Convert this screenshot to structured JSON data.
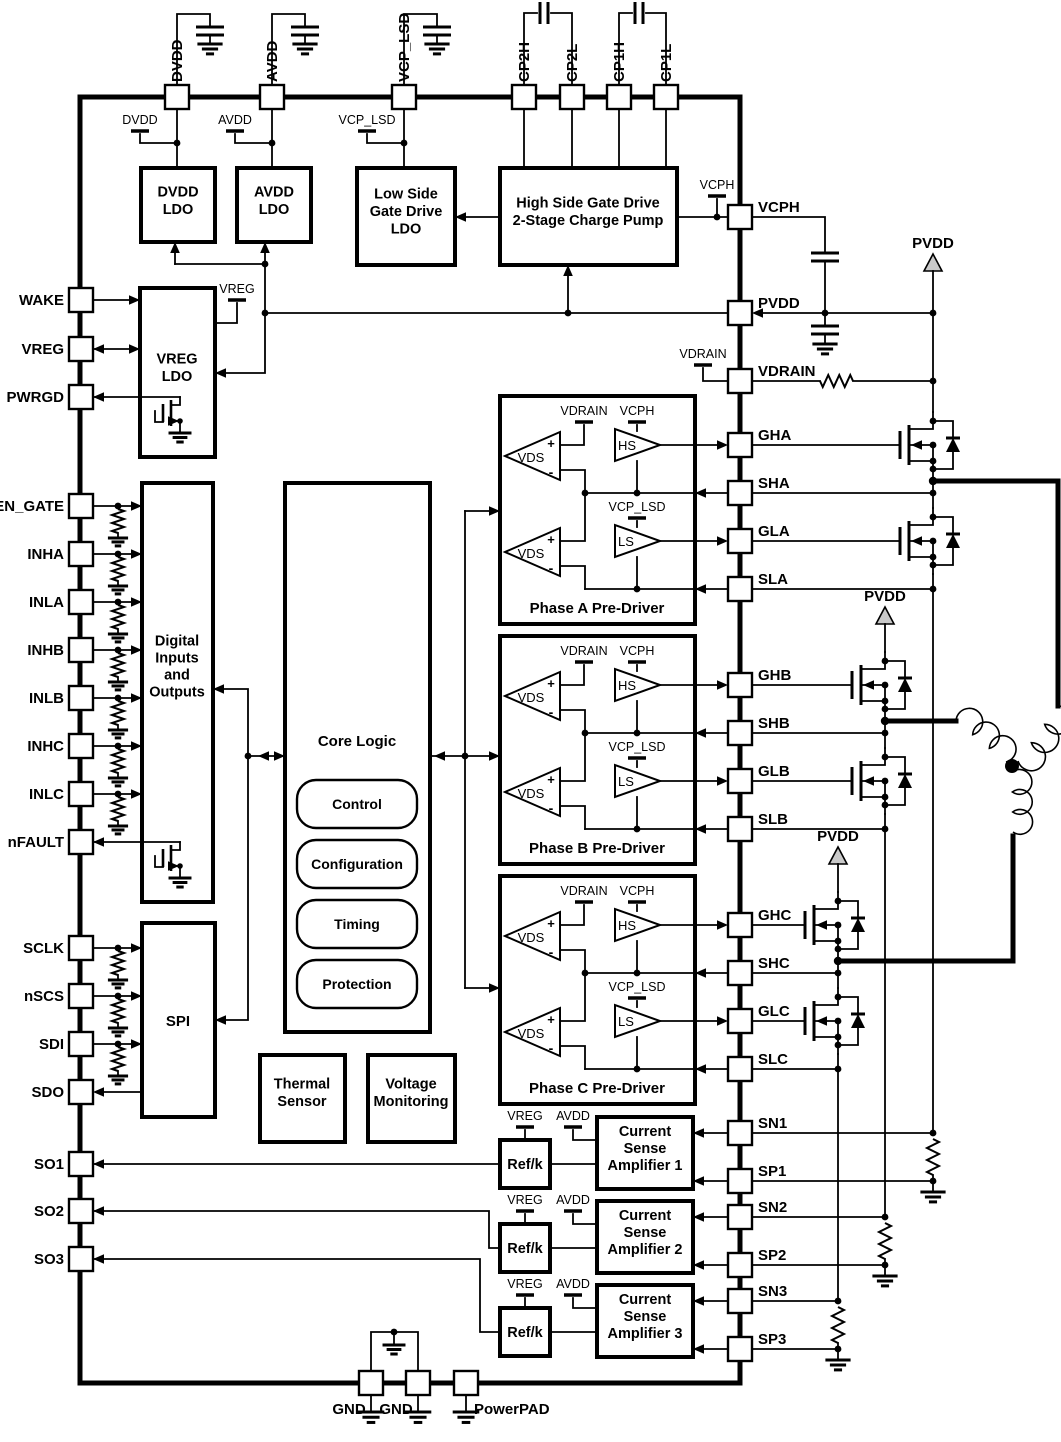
{
  "diagram_type": "ic-functional-block-diagram",
  "pins": {
    "top": [
      "DVDD",
      "AVDD",
      "VCP_LSD",
      "CP2H",
      "CP2L",
      "CP1H",
      "CP1L"
    ],
    "left": [
      "WAKE",
      "VREG",
      "PWRGD",
      "EN_GATE",
      "INHA",
      "INLA",
      "INHB",
      "INLB",
      "INHC",
      "INLC",
      "nFAULT",
      "SCLK",
      "nSCS",
      "SDI",
      "SDO",
      "SO1",
      "SO2",
      "SO3"
    ],
    "right": [
      "VCPH",
      "PVDD",
      "VDRAIN",
      "GHA",
      "SHA",
      "GLA",
      "SLA",
      "GHB",
      "SHB",
      "GLB",
      "SLB",
      "GHC",
      "SHC",
      "GLC",
      "SLC",
      "SN1",
      "SP1",
      "SN2",
      "SP2",
      "SN3",
      "SP3"
    ],
    "bottom": [
      "GND",
      "GND",
      "PowerPAD"
    ]
  },
  "blocks": {
    "dvdd_ldo": {
      "lines": [
        "DVDD",
        "LDO"
      ]
    },
    "avdd_ldo": {
      "lines": [
        "AVDD",
        "LDO"
      ]
    },
    "lowside_ldo": {
      "lines": [
        "Low Side",
        "Gate Drive",
        "LDO"
      ]
    },
    "charge_pump": {
      "lines": [
        "High Side Gate Drive",
        "2-Stage Charge Pump"
      ]
    },
    "vreg_ldo": {
      "lines": [
        "VREG",
        "LDO"
      ]
    },
    "digital_io": {
      "lines": [
        "Digital",
        "Inputs",
        "and",
        "Outputs"
      ]
    },
    "core_logic": {
      "title": "Core Logic",
      "modules": [
        "Control",
        "Configuration",
        "Timing",
        "Protection"
      ]
    },
    "spi": {
      "lines": [
        "SPI"
      ]
    },
    "thermal_sensor": {
      "lines": [
        "Thermal",
        "Sensor"
      ]
    },
    "voltage_monitoring": {
      "lines": [
        "Voltage",
        "Monitoring"
      ]
    },
    "phase_a": {
      "label": "Phase A Pre-Driver"
    },
    "phase_b": {
      "label": "Phase B Pre-Driver"
    },
    "phase_c": {
      "label": "Phase C Pre-Driver"
    },
    "ref_k": {
      "label": "Ref/k"
    },
    "csa1": {
      "lines": [
        "Current",
        "Sense",
        "Amplifier 1"
      ]
    },
    "csa2": {
      "lines": [
        "Current",
        "Sense",
        "Amplifier 2"
      ]
    },
    "csa3": {
      "lines": [
        "Current",
        "Sense",
        "Amplifier 3"
      ]
    }
  },
  "predriver_symbols": {
    "hs": "HS",
    "ls": "LS",
    "vds": "VDS",
    "plus": "+",
    "minus": "-"
  },
  "supplies": {
    "dvdd": "DVDD",
    "avdd": "AVDD",
    "vcp_lsd": "VCP_LSD",
    "vcph": "VCPH",
    "vreg": "VREG",
    "vdrain": "VDRAIN",
    "pvdd": "PVDD"
  },
  "colors": {
    "wire": "#000000",
    "background": "#ffffff",
    "supply_triangle_fill": "#c9c9c9"
  }
}
